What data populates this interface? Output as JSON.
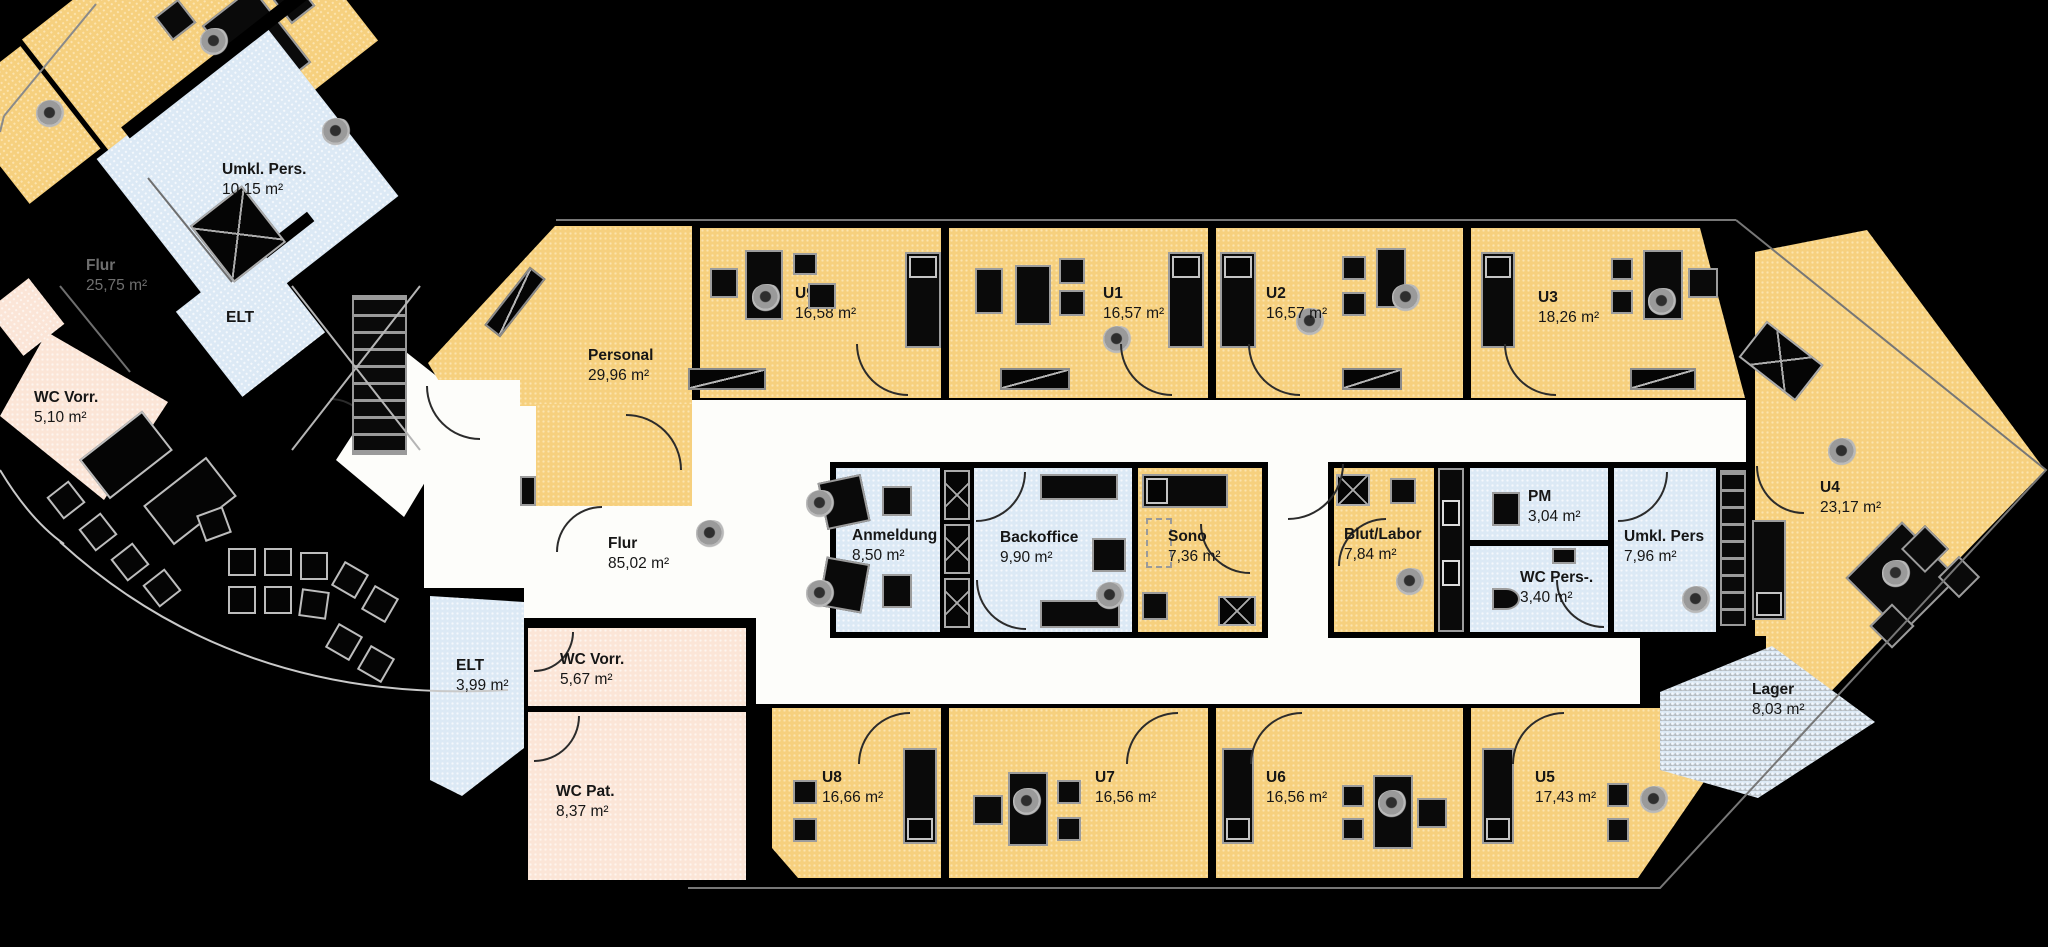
{
  "type": "floor-plan",
  "language": "de",
  "colors": {
    "background": "#000000",
    "exam_room": "#F6D07E",
    "utility_room": "#DCE9F5",
    "sanitary_room": "#FBE5D7",
    "corridor": "#FDFDFA",
    "outline_grey": "#9A9A9A"
  },
  "rooms": {
    "personal": {
      "label": "Personal",
      "area": "29,96 m²"
    },
    "u9": {
      "label": "U9",
      "area": "16,58 m²"
    },
    "u1": {
      "label": "U1",
      "area": "16,57 m²"
    },
    "u2": {
      "label": "U2",
      "area": "16,57 m²"
    },
    "u3": {
      "label": "U3",
      "area": "18,26 m²"
    },
    "u4": {
      "label": "U4",
      "area": "23,17 m²"
    },
    "u5": {
      "label": "U5",
      "area": "17,43 m²"
    },
    "u6": {
      "label": "U6",
      "area": "16,56 m²"
    },
    "u7": {
      "label": "U7",
      "area": "16,56 m²"
    },
    "u8": {
      "label": "U8",
      "area": "16,66 m²"
    },
    "flur_main": {
      "label": "Flur",
      "area": "85,02 m²"
    },
    "flur_links": {
      "label": "Flur",
      "area": "25,75 m²"
    },
    "anmeldung": {
      "label": "Anmeldung",
      "area": "8,50 m²"
    },
    "backoffice": {
      "label": "Backoffice",
      "area": "9,90 m²"
    },
    "sono": {
      "label": "Sono",
      "area": "7,36 m²"
    },
    "blut_labor": {
      "label": "Blut/Labor",
      "area": "7,84 m²"
    },
    "pm": {
      "label": "PM",
      "area": "3,04 m²"
    },
    "wc_pers": {
      "label": "WC Pers-.",
      "area": "3,40 m²"
    },
    "umkl_pers_mitte": {
      "label": "Umkl. Pers",
      "area": "7,96 m²"
    },
    "umkl_pers_links": {
      "label": "Umkl. Pers.",
      "area": "10,15 m²"
    },
    "elt_links": {
      "label": "ELT",
      "area": ""
    },
    "elt_unten": {
      "label": "ELT",
      "area": "3,99 m²"
    },
    "wc_vorr_links": {
      "label": "WC Vorr.",
      "area": "5,10 m²"
    },
    "wc_vorr_unten": {
      "label": "WC Vorr.",
      "area": "5,67 m²"
    },
    "wc_pat": {
      "label": "WC Pat.",
      "area": "8,37 m²"
    },
    "lager": {
      "label": "Lager",
      "area": "8,03 m²"
    }
  }
}
